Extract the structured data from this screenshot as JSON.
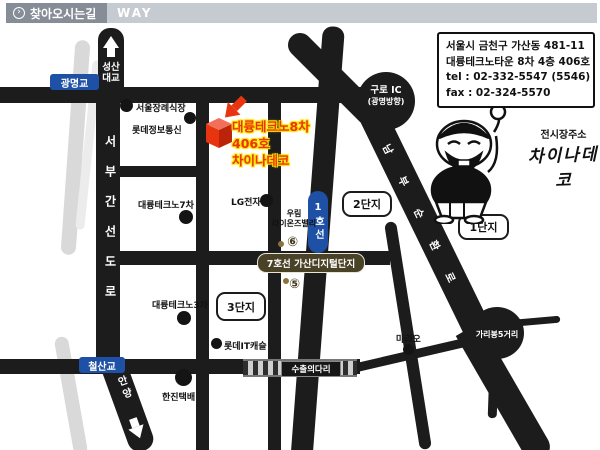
{
  "header": {
    "title": "찾아오시는길",
    "subtitle": "WAY",
    "arrow_icon": "›"
  },
  "info_box": {
    "line1": "서울시 금천구 가산동 481-11",
    "line2": "대륭테크노타운 8차 4층 406호",
    "line3": "tel : 02-332-5547 (5546)",
    "line4": "fax : 02-324-5570"
  },
  "exhibition": {
    "label": "전시장주소",
    "name": "차이나데코"
  },
  "destination": {
    "building": "대륭테크노8차",
    "room": "406호",
    "name": "차이나데코"
  },
  "roads": {
    "seongsan_line1": "성산",
    "seongsan_line2": "대교",
    "seobu": "서부간선도로",
    "nambu": "남부순환로",
    "anyang": "안양",
    "guro_ic": "구로 IC",
    "guro_ic_dir": "(광명방향)",
    "garibong": "가리봉5거리",
    "export_bridge": "수출의다리"
  },
  "bridges": {
    "gwangmyeong": "광명교",
    "cheolsan": "철산교"
  },
  "subway": {
    "line1": "1호선",
    "station": "7호선 가산디지털단지",
    "exit6": "⑥",
    "exit5": "⑤"
  },
  "landmarks": {
    "funeral": "서울장례식장",
    "lotte_info": "롯데정보통신",
    "daeryung7": "대륭테크노7차",
    "lg": "LG전자",
    "woorim_line1": "우림",
    "woorim_line2": "라이온즈밸리",
    "daeryung3": "대륭테크노3차",
    "lotte_it": "롯데IT캐슬",
    "hanjin": "한진택배",
    "mario": "마리오"
  },
  "districts": {
    "d1": "1단지",
    "d2": "2단지",
    "d3": "3단지"
  },
  "colors": {
    "accent_red": "#e8350f",
    "highlight_yellow": "#ffe300",
    "subway_blue": "#1e51a5",
    "station_olive": "#4a4227",
    "road_black": "#1c1c1c"
  }
}
